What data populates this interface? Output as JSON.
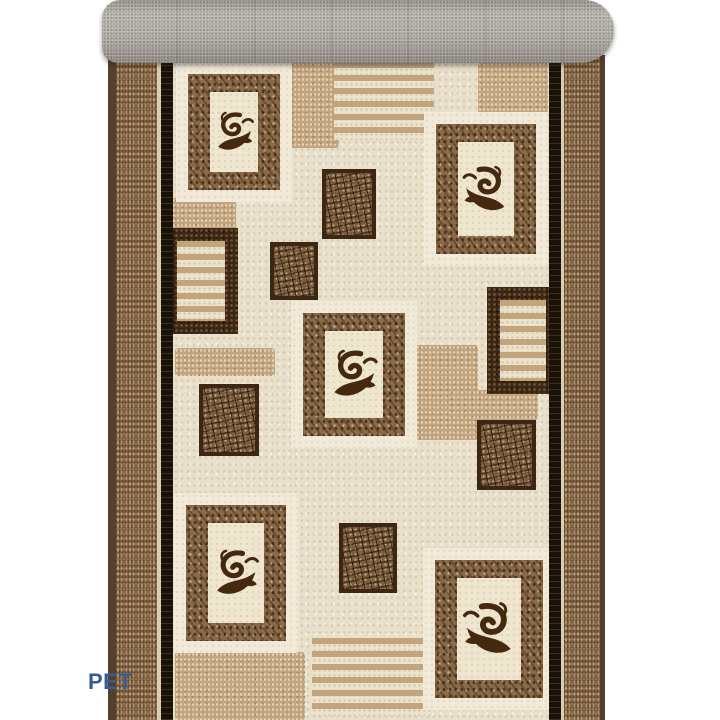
{
  "scene": {
    "subject": "rolled beige-brown ornamental carpet runner, product photo on white"
  },
  "watermark": {
    "text": "PET"
  },
  "colors": {
    "background": "#ffffff",
    "roll_gray": "#a8a39c",
    "edge_brown": "#54402c",
    "band_brown": "#7b5c3d",
    "black_line": "#191209",
    "field_cream": "#e9e0cb",
    "tan": "#c2a47d",
    "frame_cream": "#f1ead9",
    "panel_cream": "#efe6cf",
    "mottled_brown": "#8a6a47",
    "crackle_brown": "#7c5c3b",
    "dark_brown": "#3c2715",
    "scroll_brown": "#45290f",
    "watermark_blue": "#3a5a96"
  },
  "roll": {
    "x": 102,
    "y": 0,
    "w": 512,
    "h": 63
  },
  "runner": {
    "x": 108,
    "y": 55,
    "w": 497,
    "h": 665
  },
  "carpet": {
    "pattern_elements": [
      {
        "type": "tan-patch",
        "x": 289,
        "y": 62,
        "w": 50,
        "h": 86
      },
      {
        "type": "tan-patch",
        "x": 478,
        "y": 62,
        "w": 70,
        "h": 52
      },
      {
        "type": "tan-patch",
        "x": 172,
        "y": 198,
        "w": 64,
        "h": 32
      },
      {
        "type": "tan-patch",
        "x": 416,
        "y": 345,
        "w": 62,
        "h": 95
      },
      {
        "type": "tan-patch",
        "x": 175,
        "y": 348,
        "w": 100,
        "h": 28
      },
      {
        "type": "tan-patch",
        "x": 448,
        "y": 390,
        "w": 90,
        "h": 30
      },
      {
        "type": "tan-patch",
        "x": 175,
        "y": 652,
        "w": 130,
        "h": 68
      },
      {
        "type": "stripe-block",
        "x": 334,
        "y": 62,
        "w": 100,
        "h": 78
      },
      {
        "type": "stripe-block",
        "x": 312,
        "y": 638,
        "w": 120,
        "h": 78
      },
      {
        "type": "crackle-square",
        "x": 322,
        "y": 169,
        "w": 54,
        "h": 70
      },
      {
        "type": "crackle-square",
        "x": 270,
        "y": 242,
        "w": 48,
        "h": 58
      },
      {
        "type": "crackle-square",
        "x": 199,
        "y": 384,
        "w": 60,
        "h": 72
      },
      {
        "type": "crackle-square",
        "x": 477,
        "y": 420,
        "w": 59,
        "h": 70
      },
      {
        "type": "crackle-square",
        "x": 339,
        "y": 523,
        "w": 58,
        "h": 70
      },
      {
        "type": "striped-square",
        "x": 164,
        "y": 228,
        "w": 74,
        "h": 106
      },
      {
        "type": "striped-square",
        "x": 487,
        "y": 287,
        "w": 72,
        "h": 107
      },
      {
        "type": "ornament-square",
        "x": 176,
        "y": 62,
        "w": 116,
        "h": 140,
        "flip": false
      },
      {
        "type": "ornament-square",
        "x": 424,
        "y": 112,
        "w": 124,
        "h": 154,
        "flip": true
      },
      {
        "type": "ornament-square",
        "x": 291,
        "y": 301,
        "w": 126,
        "h": 147,
        "flip": false
      },
      {
        "type": "ornament-square",
        "x": 174,
        "y": 493,
        "w": 124,
        "h": 160,
        "flip": false
      },
      {
        "type": "ornament-square",
        "x": 423,
        "y": 548,
        "w": 132,
        "h": 162,
        "flip": true
      }
    ]
  }
}
